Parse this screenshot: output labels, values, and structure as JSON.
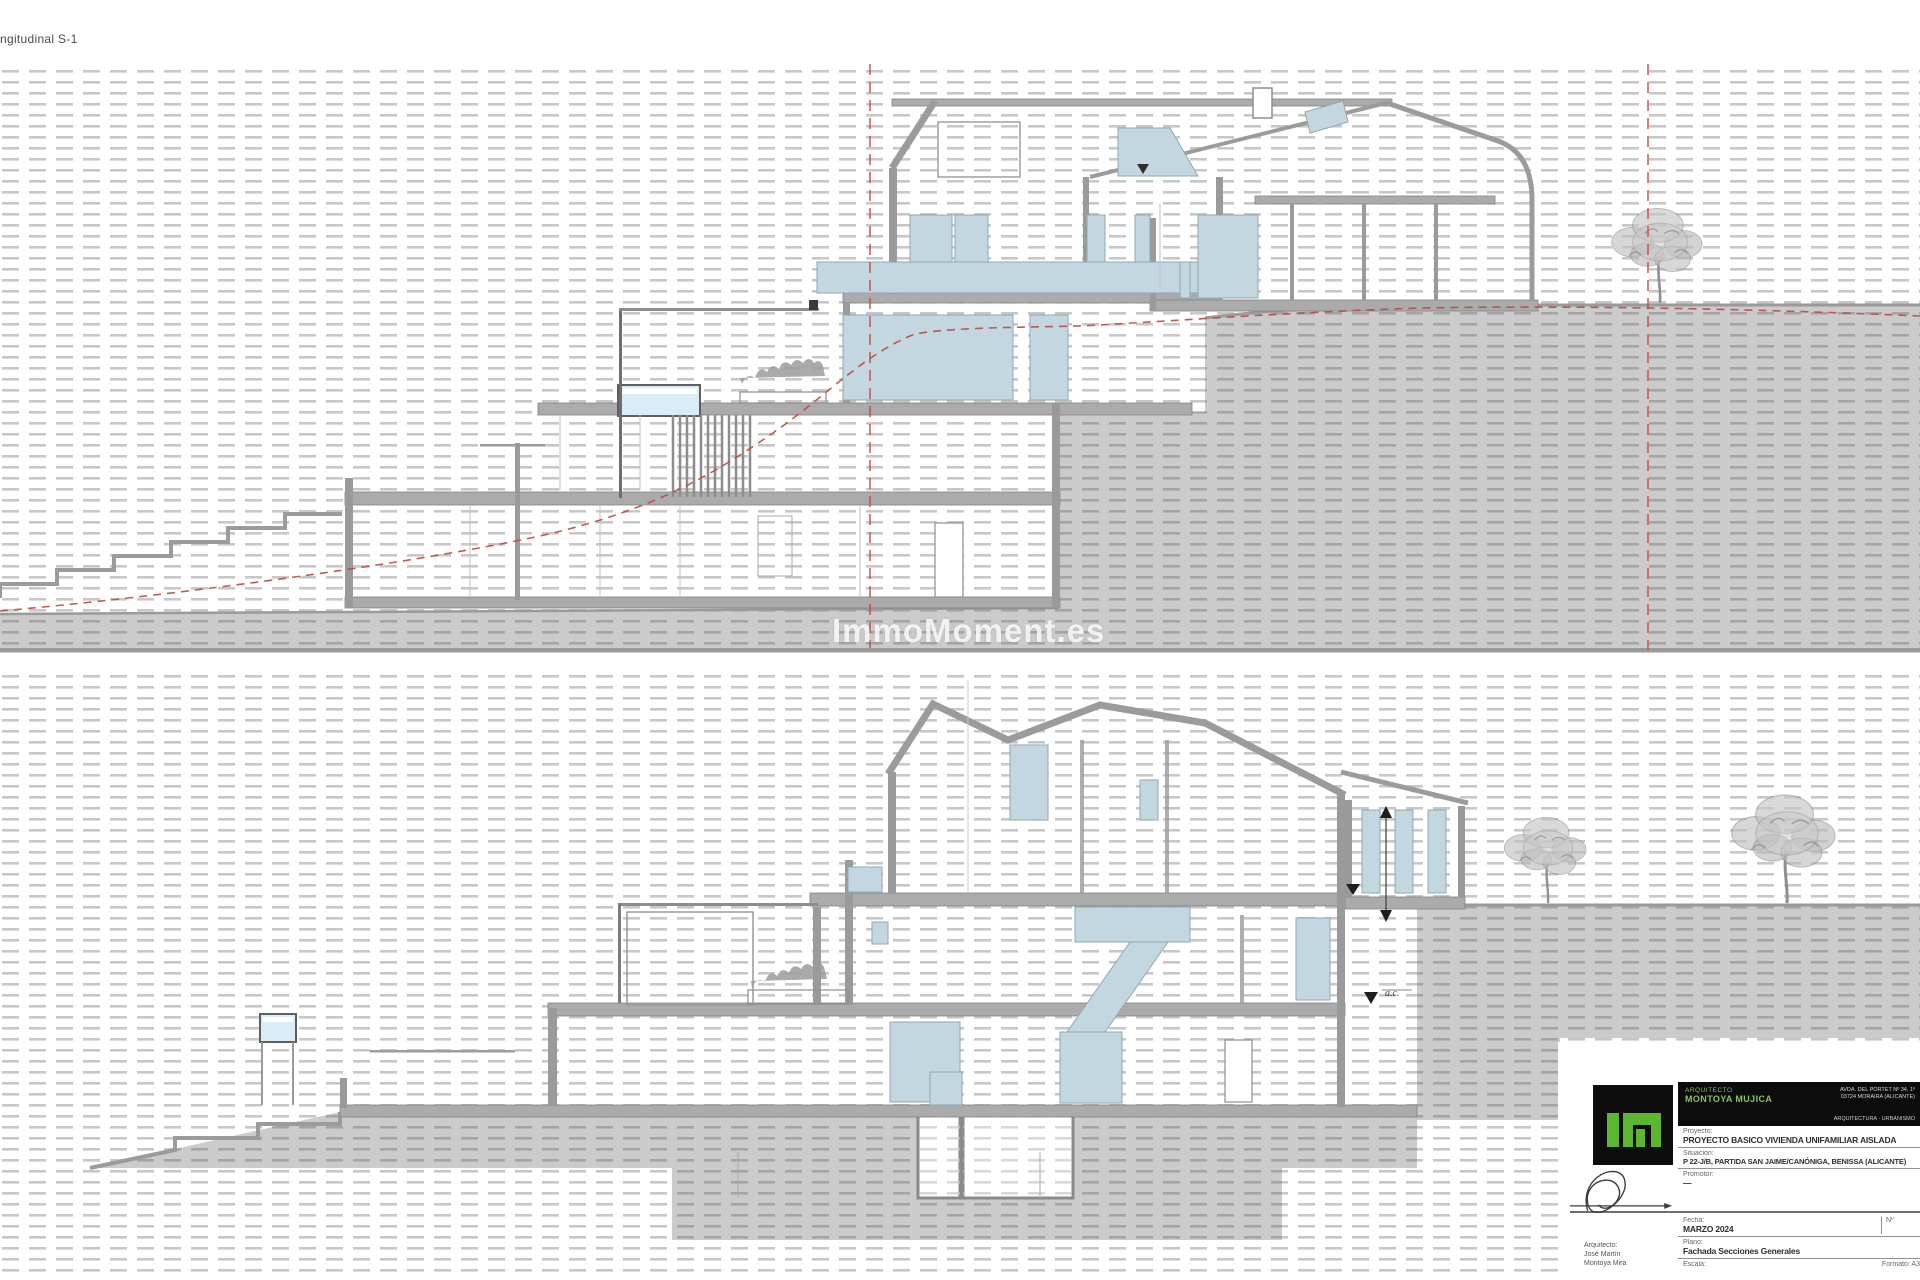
{
  "sheet": {
    "label": "ngitudinal S-1",
    "watermark": "ImmoMoment.es"
  },
  "colors": {
    "hatch_light": "#c7c7c7",
    "hatch_dark": "#a4a4a4",
    "ground_fill": "#cbcbcb",
    "wall_gray": "#9a9a9a",
    "slab_gray": "#ababab",
    "glazing_blue": "#c3d7e0",
    "pool_blue": "#d8edf7",
    "section_red": "#c0483f",
    "logo_green": "#5cb630",
    "logo_bg": "#0c0c0c"
  },
  "annotations": {
    "level_marker_label": "a.c."
  },
  "title_block": {
    "studio": {
      "profession": "ARQUITECTO",
      "name": "MONTOYA MUJICA",
      "address_line1": "AVDA. DEL PORTET Nº 34, 1º",
      "address_line2": "03724 MORAIRA (ALICANTE)",
      "address_line3": "ARQUITECTURA · URBANISMO"
    },
    "fields": {
      "project_label": "Proyecto:",
      "project_value": "PROYECTO BASICO VIVIENDA UNIFAMILIAR AISLADA",
      "site_label": "Situación:",
      "site_value": "P 22-J/B, PARTIDA SAN JAIME/CANÓNIGA, BENISSA (ALICANTE)",
      "promoter_label": "Promotor:",
      "promoter_value": "—",
      "date_label": "Fecha:",
      "date_value": "MARZO 2024",
      "sheet_no_label": "Nº",
      "plan_label": "Plano:",
      "plan_value": "Fachada Secciones Generales",
      "scale_label": "Escala:",
      "format_label": "Formato: A3"
    },
    "signature": {
      "caption_line1": "Arquitecto:",
      "caption_line2": "José Martín",
      "caption_line3": "Montoya Mira"
    }
  }
}
